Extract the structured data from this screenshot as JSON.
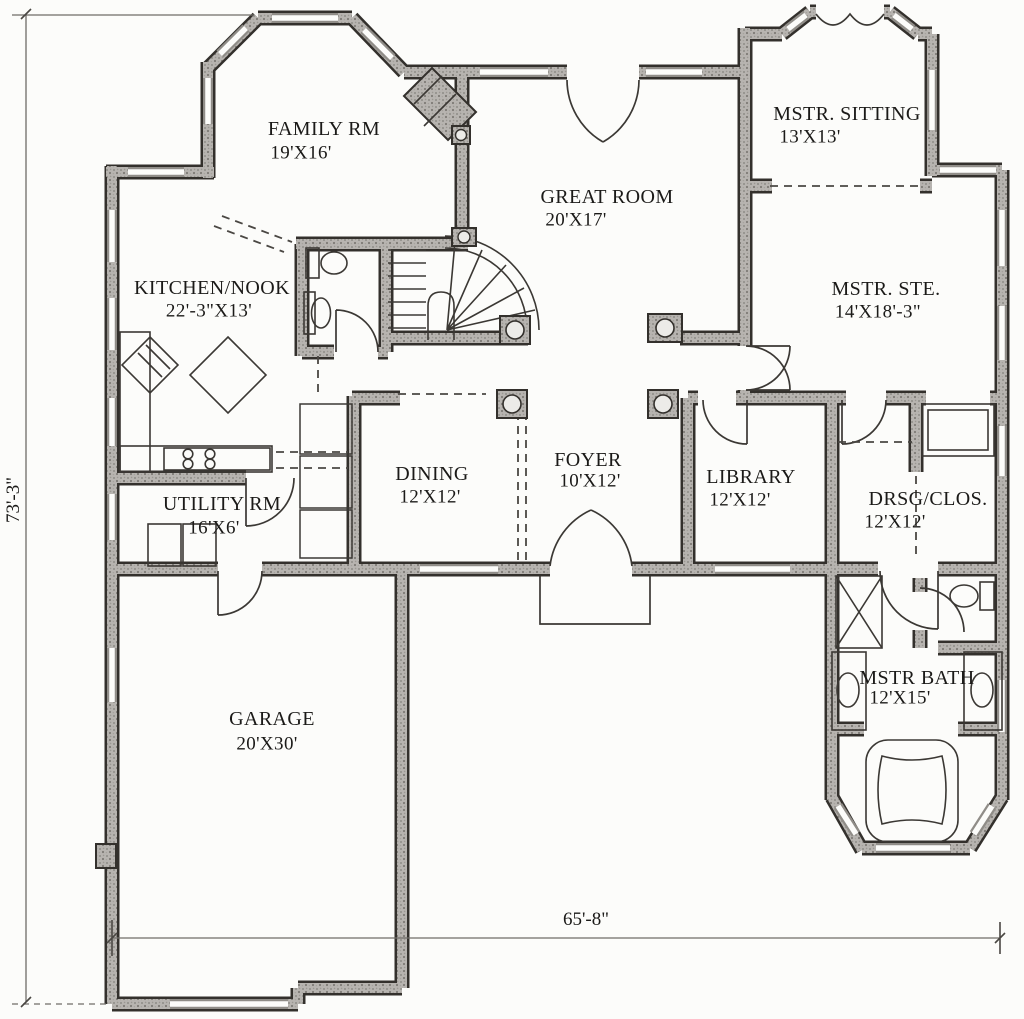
{
  "rooms": [
    {
      "id": "family-rm",
      "name": "FAMILY RM",
      "dims": "19'X16'"
    },
    {
      "id": "great-room",
      "name": "GREAT ROOM",
      "dims": "20'X17'"
    },
    {
      "id": "mstr-sitting",
      "name": "MSTR. SITTING",
      "dims": "13'X13'"
    },
    {
      "id": "mstr-ste",
      "name": "MSTR. STE.",
      "dims": "14'X18'-3\""
    },
    {
      "id": "kitchen-nook",
      "name": "KITCHEN/NOOK",
      "dims": "22'-3\"X13'"
    },
    {
      "id": "dining",
      "name": "DINING",
      "dims": "12'X12'"
    },
    {
      "id": "foyer",
      "name": "FOYER",
      "dims": "10'X12'"
    },
    {
      "id": "library",
      "name": "LIBRARY",
      "dims": "12'X12'"
    },
    {
      "id": "drsg-clos",
      "name": "DRSG/CLOS.",
      "dims": "12'X12'"
    },
    {
      "id": "utility-rm",
      "name": "UTILITY RM",
      "dims": "16'X6'"
    },
    {
      "id": "garage",
      "name": "GARAGE",
      "dims": "20'X30'"
    },
    {
      "id": "mstr-bath",
      "name": "MSTR BATH",
      "dims": "12'X15'"
    }
  ],
  "overall_dimensions": {
    "height": "73'-3\"",
    "width": "65'-8\""
  },
  "colors": {
    "paper": "#fcfcfa",
    "wall_edge": "#33302c",
    "wall_fill": "#b7b4b0",
    "linework": "#3b3834"
  }
}
